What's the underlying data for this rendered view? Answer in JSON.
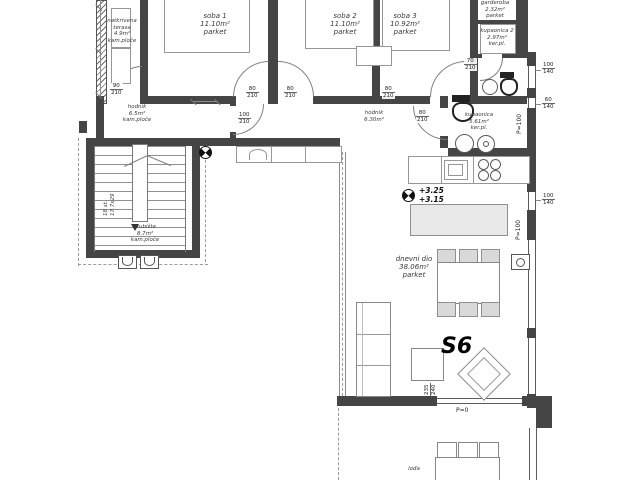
{
  "unit": {
    "label": "S6"
  },
  "rooms": {
    "soba1": {
      "name": "soba 1",
      "area": "11.10m²",
      "floor": "parket"
    },
    "soba2": {
      "name": "soba 2",
      "area": "11.10m²",
      "floor": "parket"
    },
    "soba3": {
      "name": "soba 3",
      "area": "10.92m²",
      "floor": "parket"
    },
    "garderoba": {
      "name": "garderoba",
      "area": "2.32m²",
      "floor": "parket"
    },
    "kupaonica2": {
      "name": "kupaonica 2",
      "area": "2.97m²",
      "floor": "ker.pl."
    },
    "terasa": {
      "name": "natkrivena terasa",
      "area": "4.9m²",
      "floor": "kam.ploče"
    },
    "hodnik1": {
      "name": "hodnik",
      "area": "6.5m²",
      "floor": "kam.ploče"
    },
    "hodnik2": {
      "name": "hodnik",
      "area": "6.30m²",
      "floor": ""
    },
    "kupaonica": {
      "name": "kupaonica",
      "area": "5.61m²",
      "floor": "ker.pl."
    },
    "stubiste": {
      "name": "stubište",
      "area": "8.7m²",
      "floor": "kam.ploče"
    },
    "dnevni": {
      "name": "dnevni dio",
      "area": "38.06m²",
      "floor": "parket"
    },
    "loda": {
      "name": "lođa",
      "area": "",
      "floor": ""
    }
  },
  "door_tags": {
    "terasa": {
      "w": "90",
      "h": "210"
    },
    "soba1": {
      "w": "80",
      "h": "210"
    },
    "soba2": {
      "w": "80",
      "h": "210"
    },
    "soba3": {
      "w": "80",
      "h": "210"
    },
    "hodnik": {
      "w": "100",
      "h": "210"
    },
    "kupaonica": {
      "w": "80",
      "h": "210"
    },
    "kupaonica2": {
      "w": "70",
      "h": "210"
    }
  },
  "window_tags": {
    "win1": {
      "w": "100",
      "h": "140"
    },
    "win2": {
      "w": "60",
      "h": "140"
    },
    "win3": {
      "w": "100",
      "h": "140"
    },
    "loggia_door": {
      "w": "235",
      "h": "240"
    }
  },
  "levels": {
    "upper": "+3.25",
    "lower": "+3.15",
    "parapet_a": "P=100",
    "parapet_b": "P=100",
    "loggia": "P=0"
  },
  "stair_note": {
    "l1": "18 st.",
    "l2": "17.7x29"
  }
}
